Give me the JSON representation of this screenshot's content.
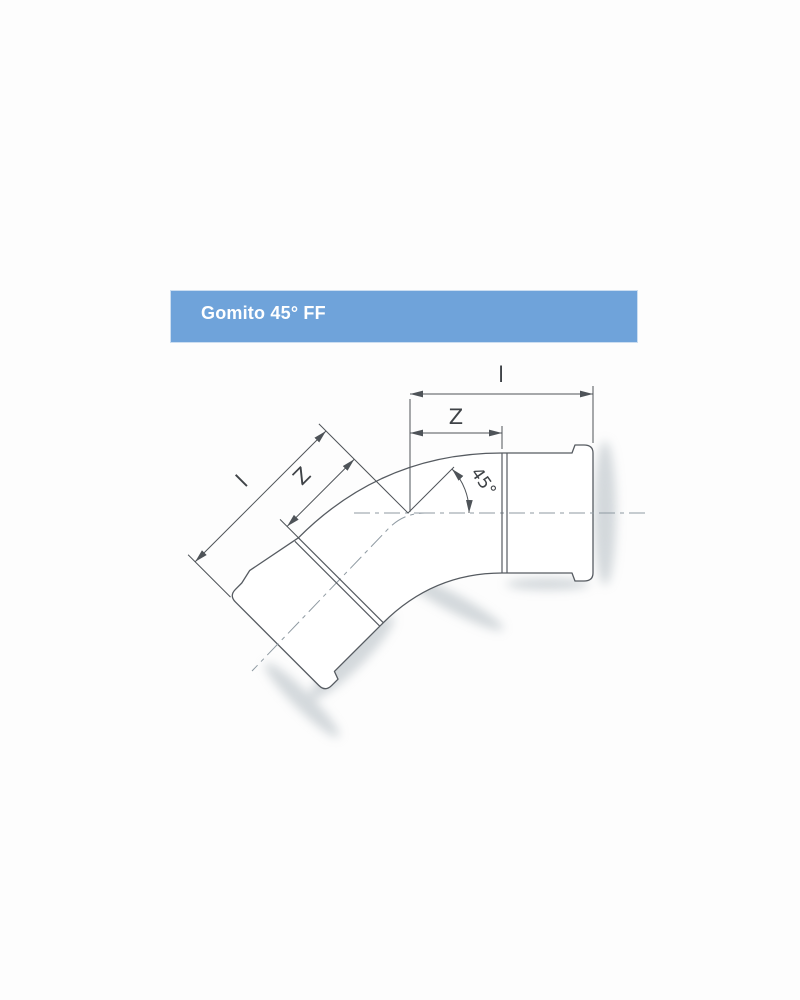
{
  "header": {
    "title": "Gomito 45° FF"
  },
  "drawing": {
    "subject": "45-degree female-female press-fit elbow, side view technical drawing",
    "angle_label": "45°",
    "dimensions": {
      "horizontal_total_label": "l",
      "horizontal_engagement_label": "Z",
      "diagonal_total_label": "l",
      "diagonal_engagement_label": "Z"
    }
  },
  "colors": {
    "header_bg": "#6fa3da",
    "header_text": "#ffffff",
    "outline": "#565b61",
    "dimension_line": "#4e5358",
    "centerline": "#8f9aa2",
    "shadow": "#a9b3ba",
    "page_bg": "#fdfdfd"
  }
}
